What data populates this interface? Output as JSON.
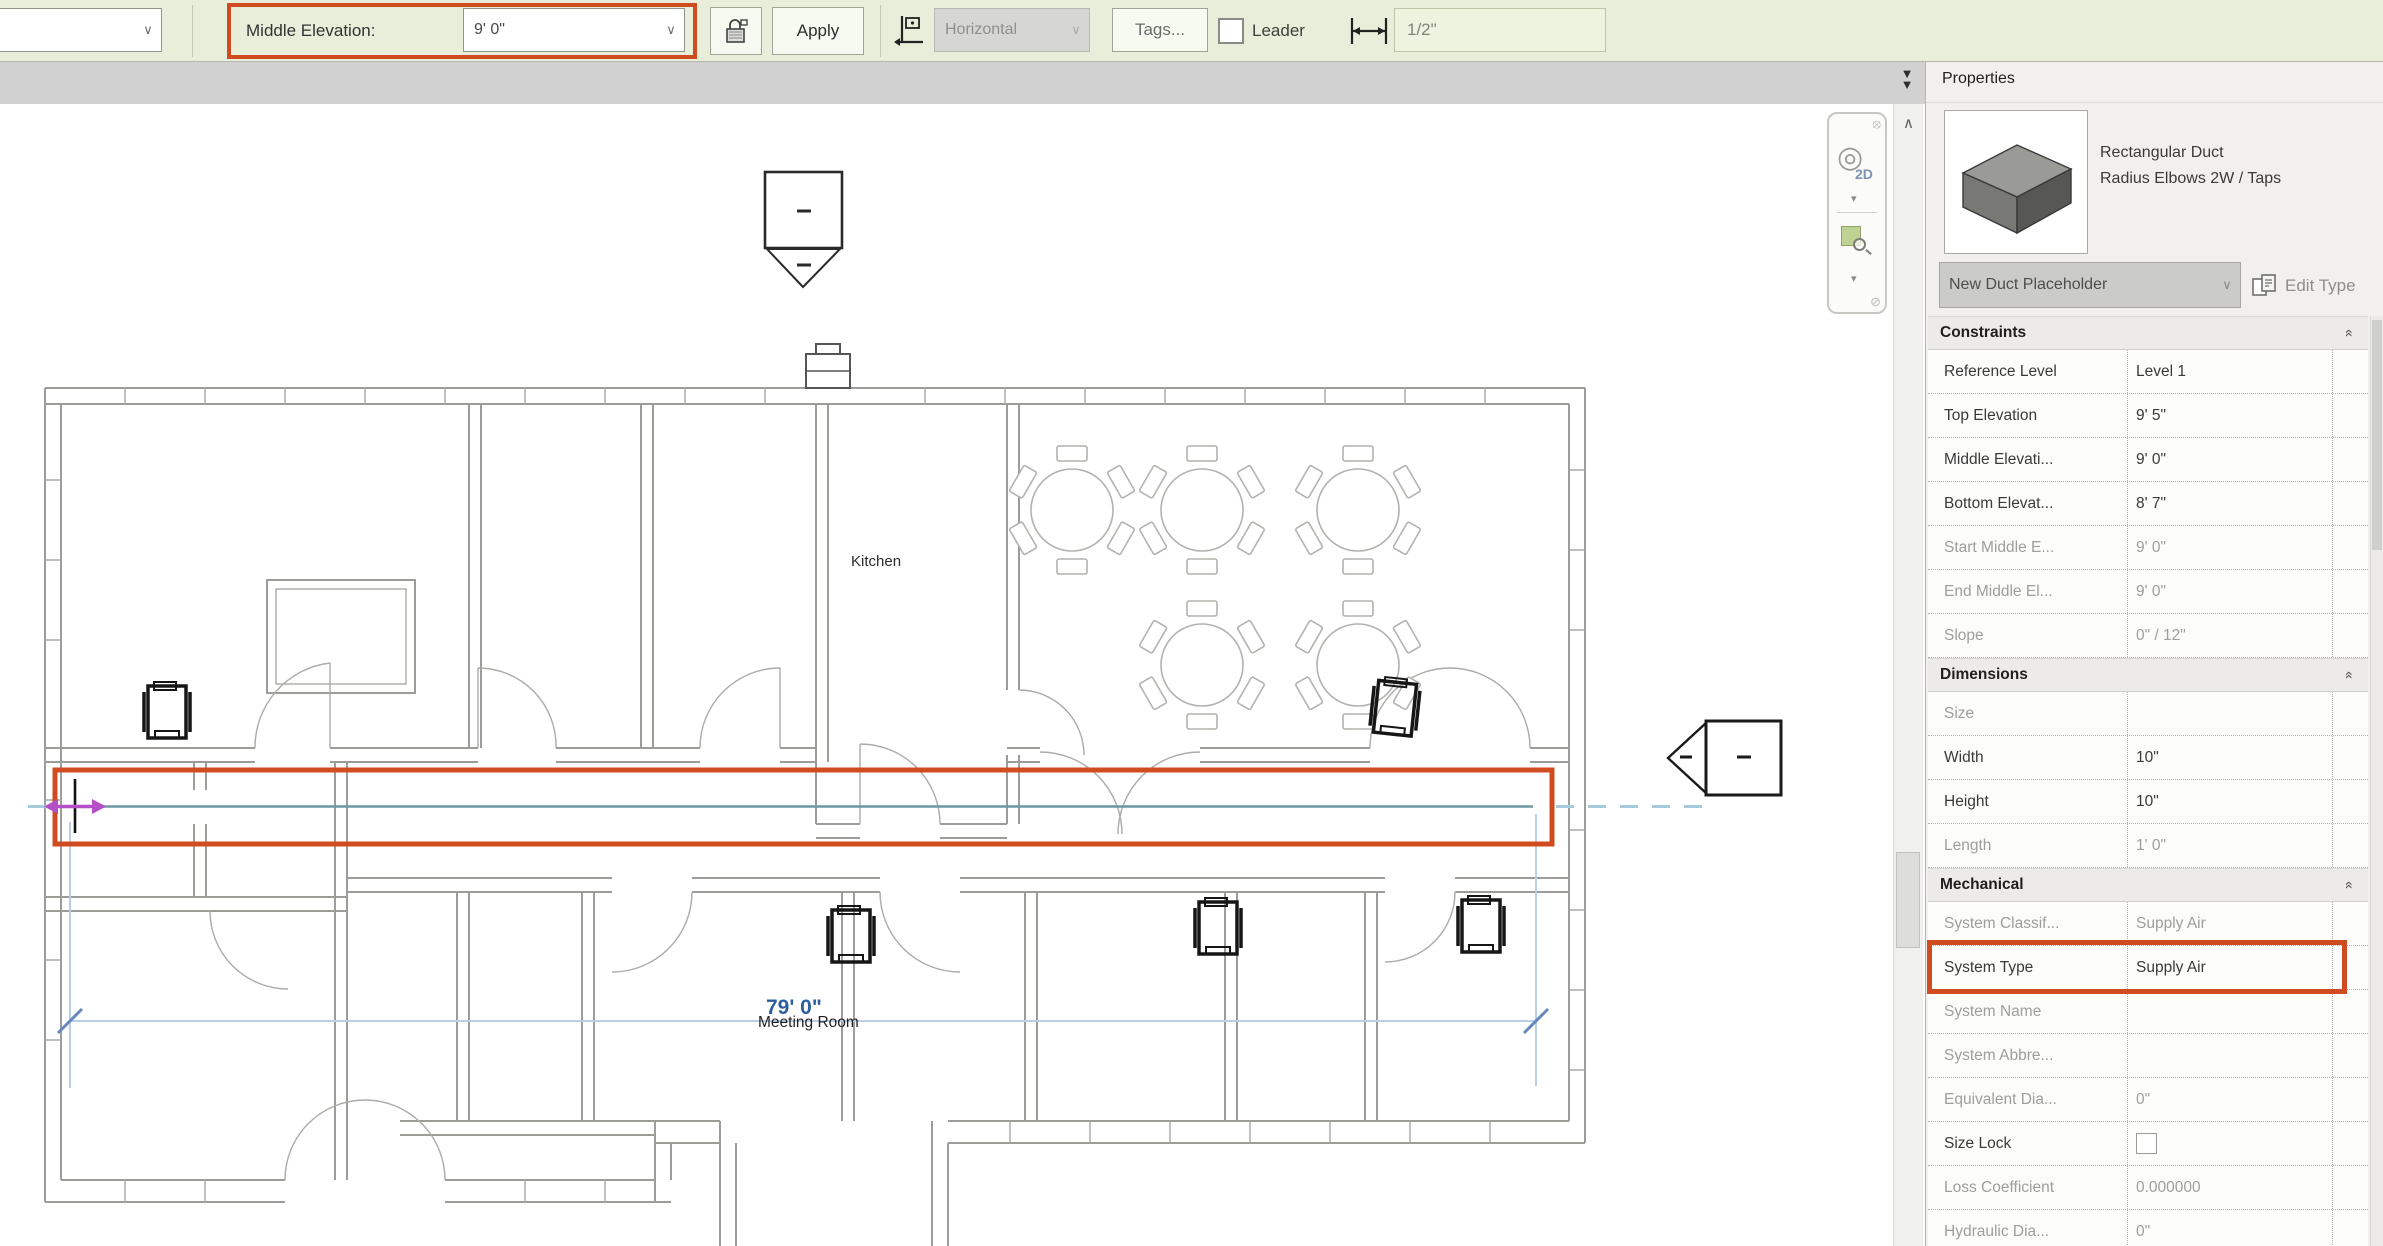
{
  "options_bar": {
    "middle_elevation_label": "Middle Elevation:",
    "middle_elevation_value": "9' 0\"",
    "apply_label": "Apply",
    "orientation_value": "Horizontal",
    "tags_label": "Tags...",
    "leader_label": "Leader",
    "offset_value": "1/2\""
  },
  "canvas": {
    "kitchen_label": "Kitchen",
    "meeting_room_label": "Meeting Room",
    "dimension_text": "79'  0\"",
    "nav_2d_label": "2D"
  },
  "properties_panel": {
    "title": "Properties",
    "type_line1": "Rectangular Duct",
    "type_line2": "Radius Elbows 2W / Taps",
    "type_selector_value": "New Duct Placeholder",
    "edit_type_label": "Edit Type",
    "sections": [
      {
        "label": "Constraints",
        "rows": [
          {
            "label": "Reference Level",
            "value": "Level 1"
          },
          {
            "label": "Top Elevation",
            "value": "9' 5\""
          },
          {
            "label": "Middle Elevati...",
            "value": "9' 0\""
          },
          {
            "label": "Bottom Elevat...",
            "value": "8' 7\""
          },
          {
            "label": "Start Middle E...",
            "value": "9' 0\""
          },
          {
            "label": "End Middle El...",
            "value": "9' 0\""
          },
          {
            "label": "Slope",
            "value": "0\" / 12\""
          }
        ]
      },
      {
        "label": "Dimensions",
        "rows": [
          {
            "label": "Size",
            "value": ""
          },
          {
            "label": "Width",
            "value": "10\""
          },
          {
            "label": "Height",
            "value": "10\""
          },
          {
            "label": "Length",
            "value": "1'  0\""
          }
        ]
      },
      {
        "label": "Mechanical",
        "rows": [
          {
            "label": "System Classif...",
            "value": "Supply Air"
          },
          {
            "label": "System Type",
            "value": "Supply Air"
          },
          {
            "label": "System Name",
            "value": ""
          },
          {
            "label": "System Abbre...",
            "value": ""
          },
          {
            "label": "Equivalent Dia...",
            "value": "0\""
          },
          {
            "label": "Size Lock",
            "value": ""
          },
          {
            "label": "Loss Coefficient",
            "value": "0.000000"
          },
          {
            "label": "Hydraulic Dia...",
            "value": "0\""
          }
        ]
      }
    ]
  },
  "colors": {
    "highlight_red": "#d14b20",
    "duct_centerline_teal": "#6f98a2",
    "dimension_blue": "#2d5f9e",
    "cursor_magenta": "#b44fc8",
    "options_bar_green": "#e8eeda"
  }
}
